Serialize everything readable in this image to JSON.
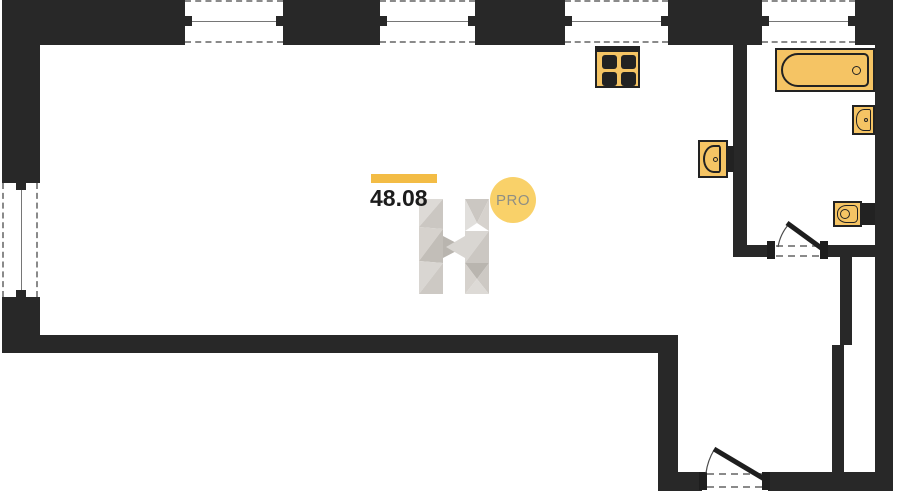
{
  "watermark": {
    "area_value": "48.08",
    "badge_label": "PRO"
  },
  "colors": {
    "wall": "#282828",
    "fixture_fill": "#F5C464",
    "fixture_border": "#222222",
    "accent_bar": "#F3BC45",
    "badge_fill": "#F9D169",
    "badge_text": "#8F8F84",
    "dash": "#8A8A8A",
    "pane_line": "#767676",
    "door_leaf": "#1E1E1E",
    "door_arc": "#4A4A4A",
    "watermark_grays": [
      "#DDDAD6",
      "#CBC7C2",
      "#D6D2CD",
      "#C2BEB8",
      "#D9D6D2",
      "#CDC9C4",
      "#E1DFDC",
      "#B9B5AF"
    ]
  },
  "fixtures": {
    "stove": "stove-icon",
    "bathtub": "bathtub-icon",
    "kitchen_sink": "kitchen-sink-icon",
    "washbasin": "washbasin-icon",
    "toilet": "toilet-icon"
  },
  "doors": {
    "bathroom": "swing-door",
    "entrance": "swing-door"
  }
}
